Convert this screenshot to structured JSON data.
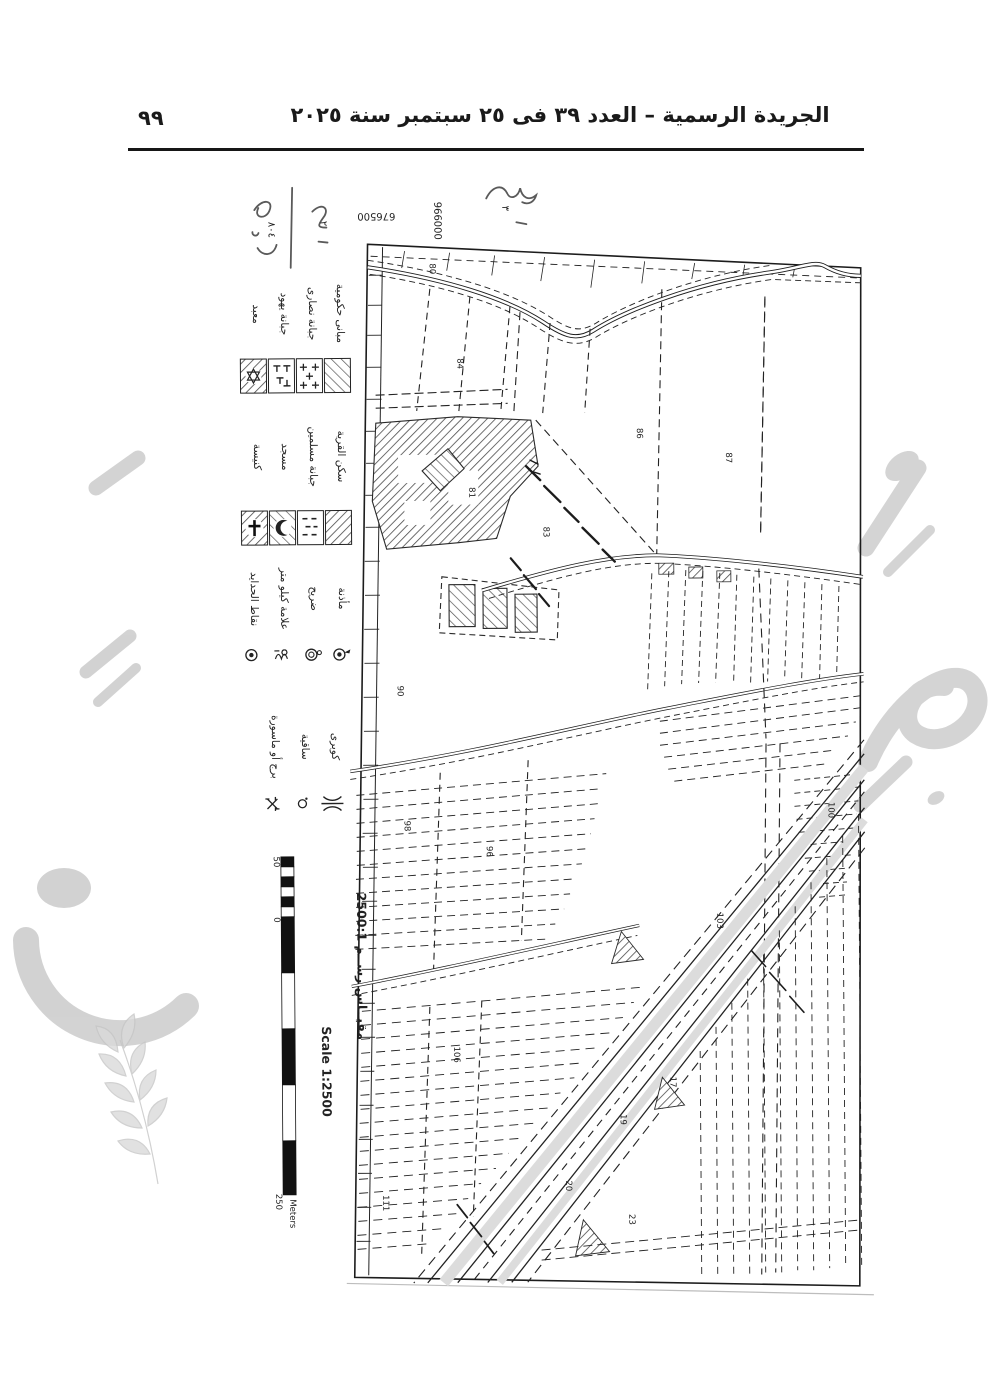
{
  "header": {
    "page_number": "٩٩",
    "title": "الجريدة الرسمية – العدد ٣٩ فى ٢٥ سبتمبر سنة ٢٠٢٥"
  },
  "map": {
    "coordinates": {
      "northing": "966000",
      "easting": "676500"
    },
    "annotations": {
      "a1": "٨٠٤",
      "a2": "٢",
      "a3": "٣"
    },
    "legend": {
      "groups": [
        {
          "items": [
            {
              "label": "معبد",
              "symbol": "hatched-box-star"
            },
            {
              "label": "جبانة يهود",
              "symbol": "box-grave-marks"
            },
            {
              "label": "جبانة نصارى",
              "symbol": "box-crosses"
            },
            {
              "label": "مبانى حكومية",
              "symbol": "hatched-box"
            }
          ]
        },
        {
          "items": [
            {
              "label": "كنيسة",
              "symbol": "hatched-box-cross"
            },
            {
              "label": "مسجد",
              "symbol": "hatched-box-crescent"
            },
            {
              "label": "جبانة مسلمين",
              "symbol": "box-dashes"
            },
            {
              "label": "سكن القرية",
              "symbol": "hatched-box"
            }
          ]
        },
        {
          "items": [
            {
              "label": "نقاط الحدايد",
              "symbol": "bullseye"
            },
            {
              "label": "علامة كيلو متر",
              "symbol": "km-mark"
            },
            {
              "label": "ضريح",
              "symbol": "circle-flag"
            },
            {
              "label": "مأذنة",
              "symbol": "circle-dot-flag"
            }
          ]
        },
        {
          "items": [
            {
              "label": "برج أو ماسورة",
              "symbol": "crossed-circle"
            },
            {
              "label": "ساقية",
              "symbol": "small-circle"
            },
            {
              "label": "كوبرى",
              "symbol": "bridge"
            }
          ]
        }
      ]
    },
    "scale": {
      "ratio_ar": "مقيــاس رســم 2500:1",
      "ratio_en": "Scale 1:2500",
      "bar_labels": {
        "top": "50",
        "zero": "0",
        "bottom": "250",
        "unit": "Meters"
      }
    },
    "parcel_numbers": [
      "80",
      "84",
      "86",
      "87",
      "81",
      "83",
      "90",
      "96",
      "98",
      "100",
      "103",
      "106",
      "111",
      "17",
      "19",
      "20",
      "23"
    ]
  }
}
